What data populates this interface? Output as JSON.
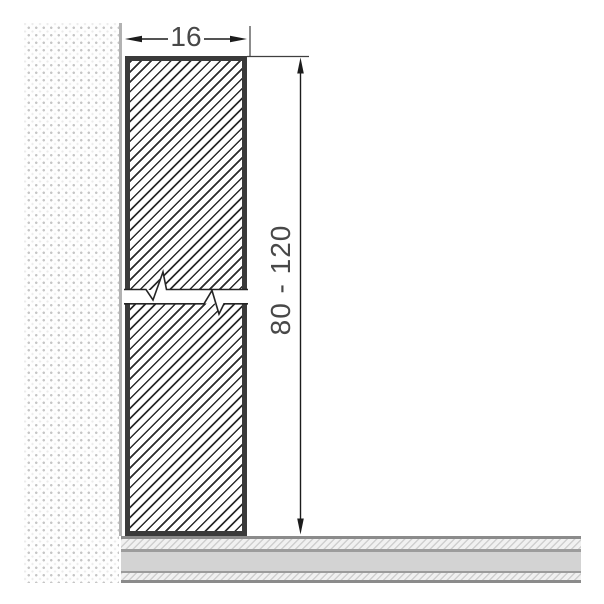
{
  "drawing": {
    "labels": {
      "width_dim": "16",
      "height_dim": "80 - 120"
    },
    "colors": {
      "profile_outline": "#3a3a3a",
      "hatch_line": "#2b2b2b",
      "dimension_ink": "#1c1c1c",
      "dimension_text": "#484848",
      "wall_dot": "#c6c6c6",
      "wall_edge": "#b2b2b2",
      "floor_core": "#d3d3d3",
      "floor_border": "#8b8b8b",
      "floor_hatch_line": "#cfcfcf",
      "background": "#ffffff"
    }
  }
}
